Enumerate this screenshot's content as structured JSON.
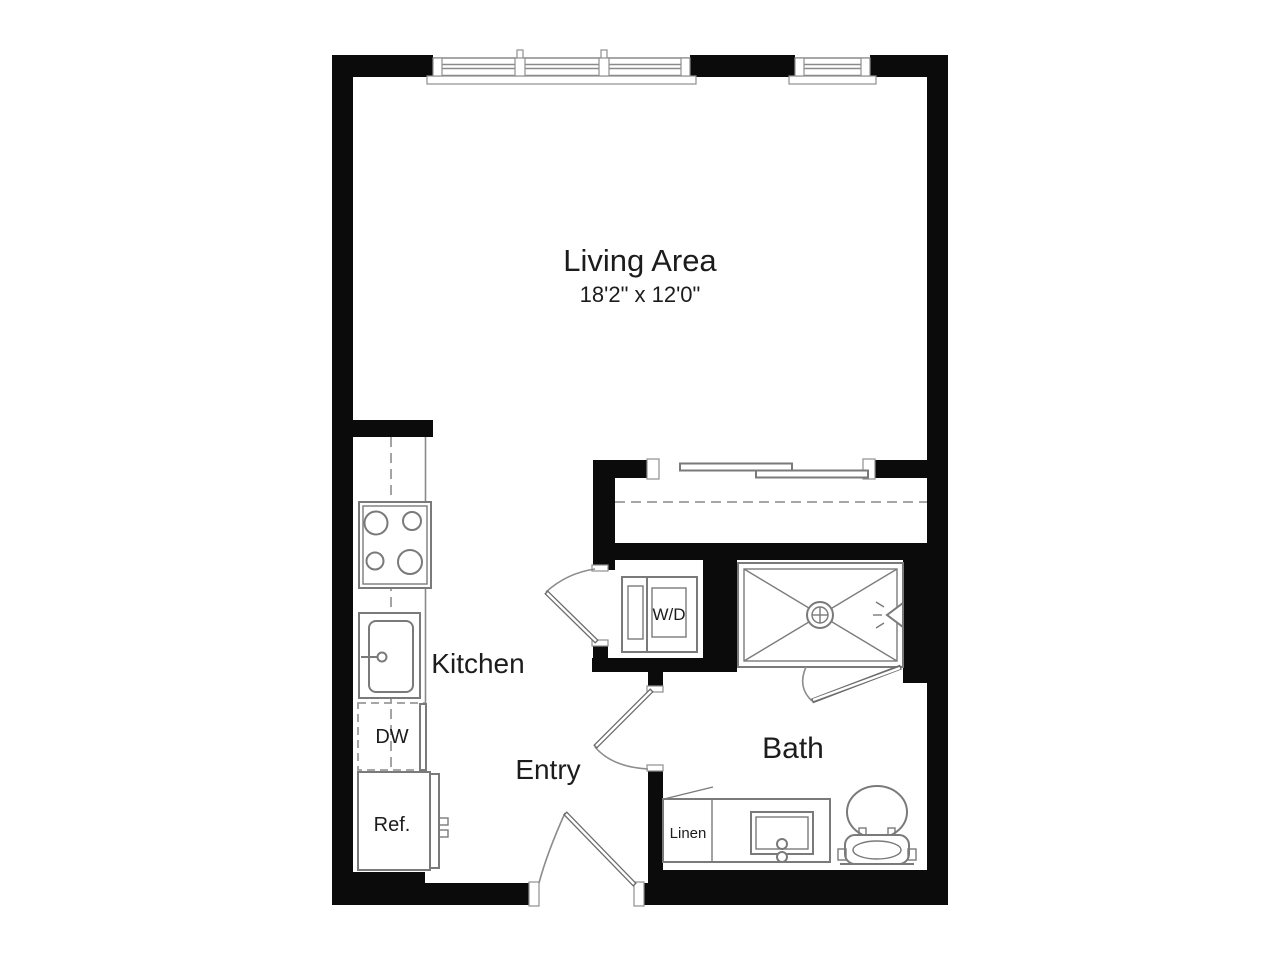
{
  "floorplan": {
    "rooms": {
      "living": {
        "label": "Living Area",
        "dimensions": "18'2\" x 12'0\""
      },
      "kitchen": {
        "label": "Kitchen"
      },
      "entry": {
        "label": "Entry"
      },
      "bath": {
        "label": "Bath"
      }
    },
    "appliances": {
      "washer_dryer": "W/D",
      "dishwasher": "DW",
      "refrigerator": "Ref.",
      "linen_closet": "Linen"
    },
    "colors": {
      "wall": "#0b0b0b",
      "fixture_line": "#7a7a7a",
      "door_line": "#6b6b6b",
      "dash_line": "#9a9a9a",
      "text_primary": "#1c1c1c",
      "background": "#ffffff"
    }
  }
}
